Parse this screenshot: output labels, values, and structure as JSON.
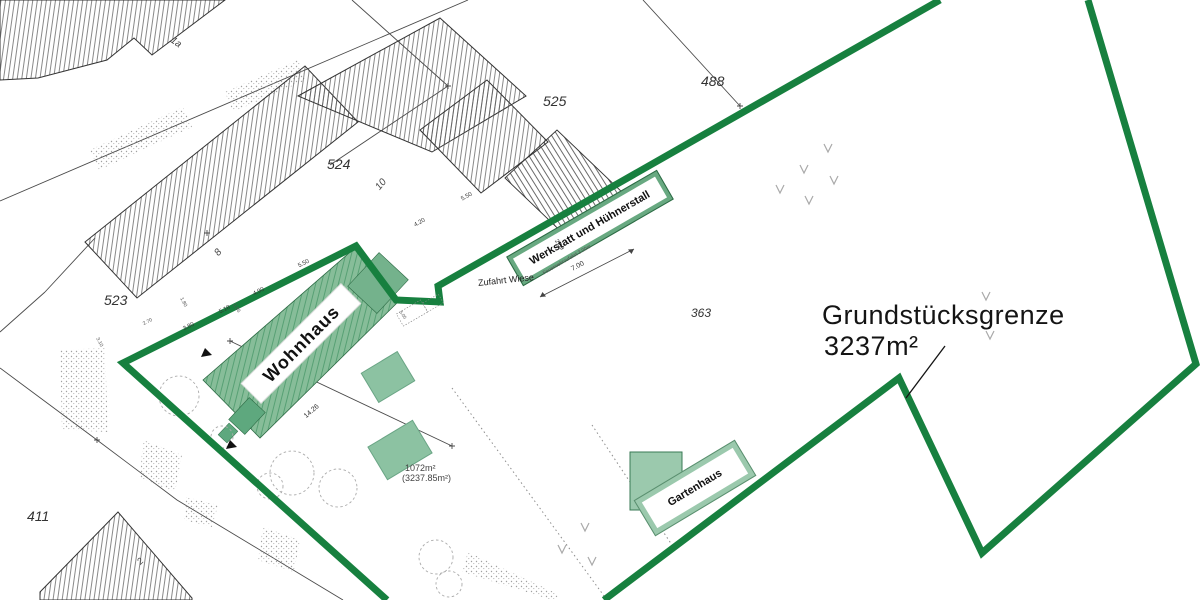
{
  "title": {
    "line1": "Grundstücksgrenze",
    "line2": "3237m²"
  },
  "parcel_numbers": {
    "p523": "523",
    "p524": "524",
    "p525": "525",
    "p488": "488",
    "p363": "363",
    "p411": "411"
  },
  "building_numbers": {
    "b1a": "1a",
    "b8": "8",
    "b10": "10",
    "b2": "2"
  },
  "building_labels": {
    "wohnhaus": "Wohnhaus",
    "werkstatt": "Werkstatt und Hühnerstall",
    "gartenhaus": "Gartenhaus"
  },
  "annotations": {
    "zufahrt_wiese": "Zufahrt Wiese",
    "area_inner": "1072m²",
    "area_total": "(3237.85m²)",
    "feuerwehr": "Feuerwehrzufahrt 3.00m"
  },
  "dimensions": {
    "d380": "3.80",
    "d518": "5.18",
    "d490": "4.90",
    "d550a": "5.50",
    "d420": "4.20",
    "d550b": "5.50",
    "d209": "2.09",
    "d700": "7.00",
    "d1426": "14.26",
    "d180": "1.80",
    "d270": "2.70",
    "d386": "3.86",
    "d505": "5.05",
    "d310": "3.10"
  },
  "colors": {
    "boundary_green": "#17803f",
    "building_fill_green": "#87bd99",
    "hatch_green": "#57a074",
    "label_box_green": "#68a981",
    "gartenhaus_fill": "#9bc9ad",
    "shed_fill": "#8cc2a2",
    "hatch_gray": "#555555"
  }
}
